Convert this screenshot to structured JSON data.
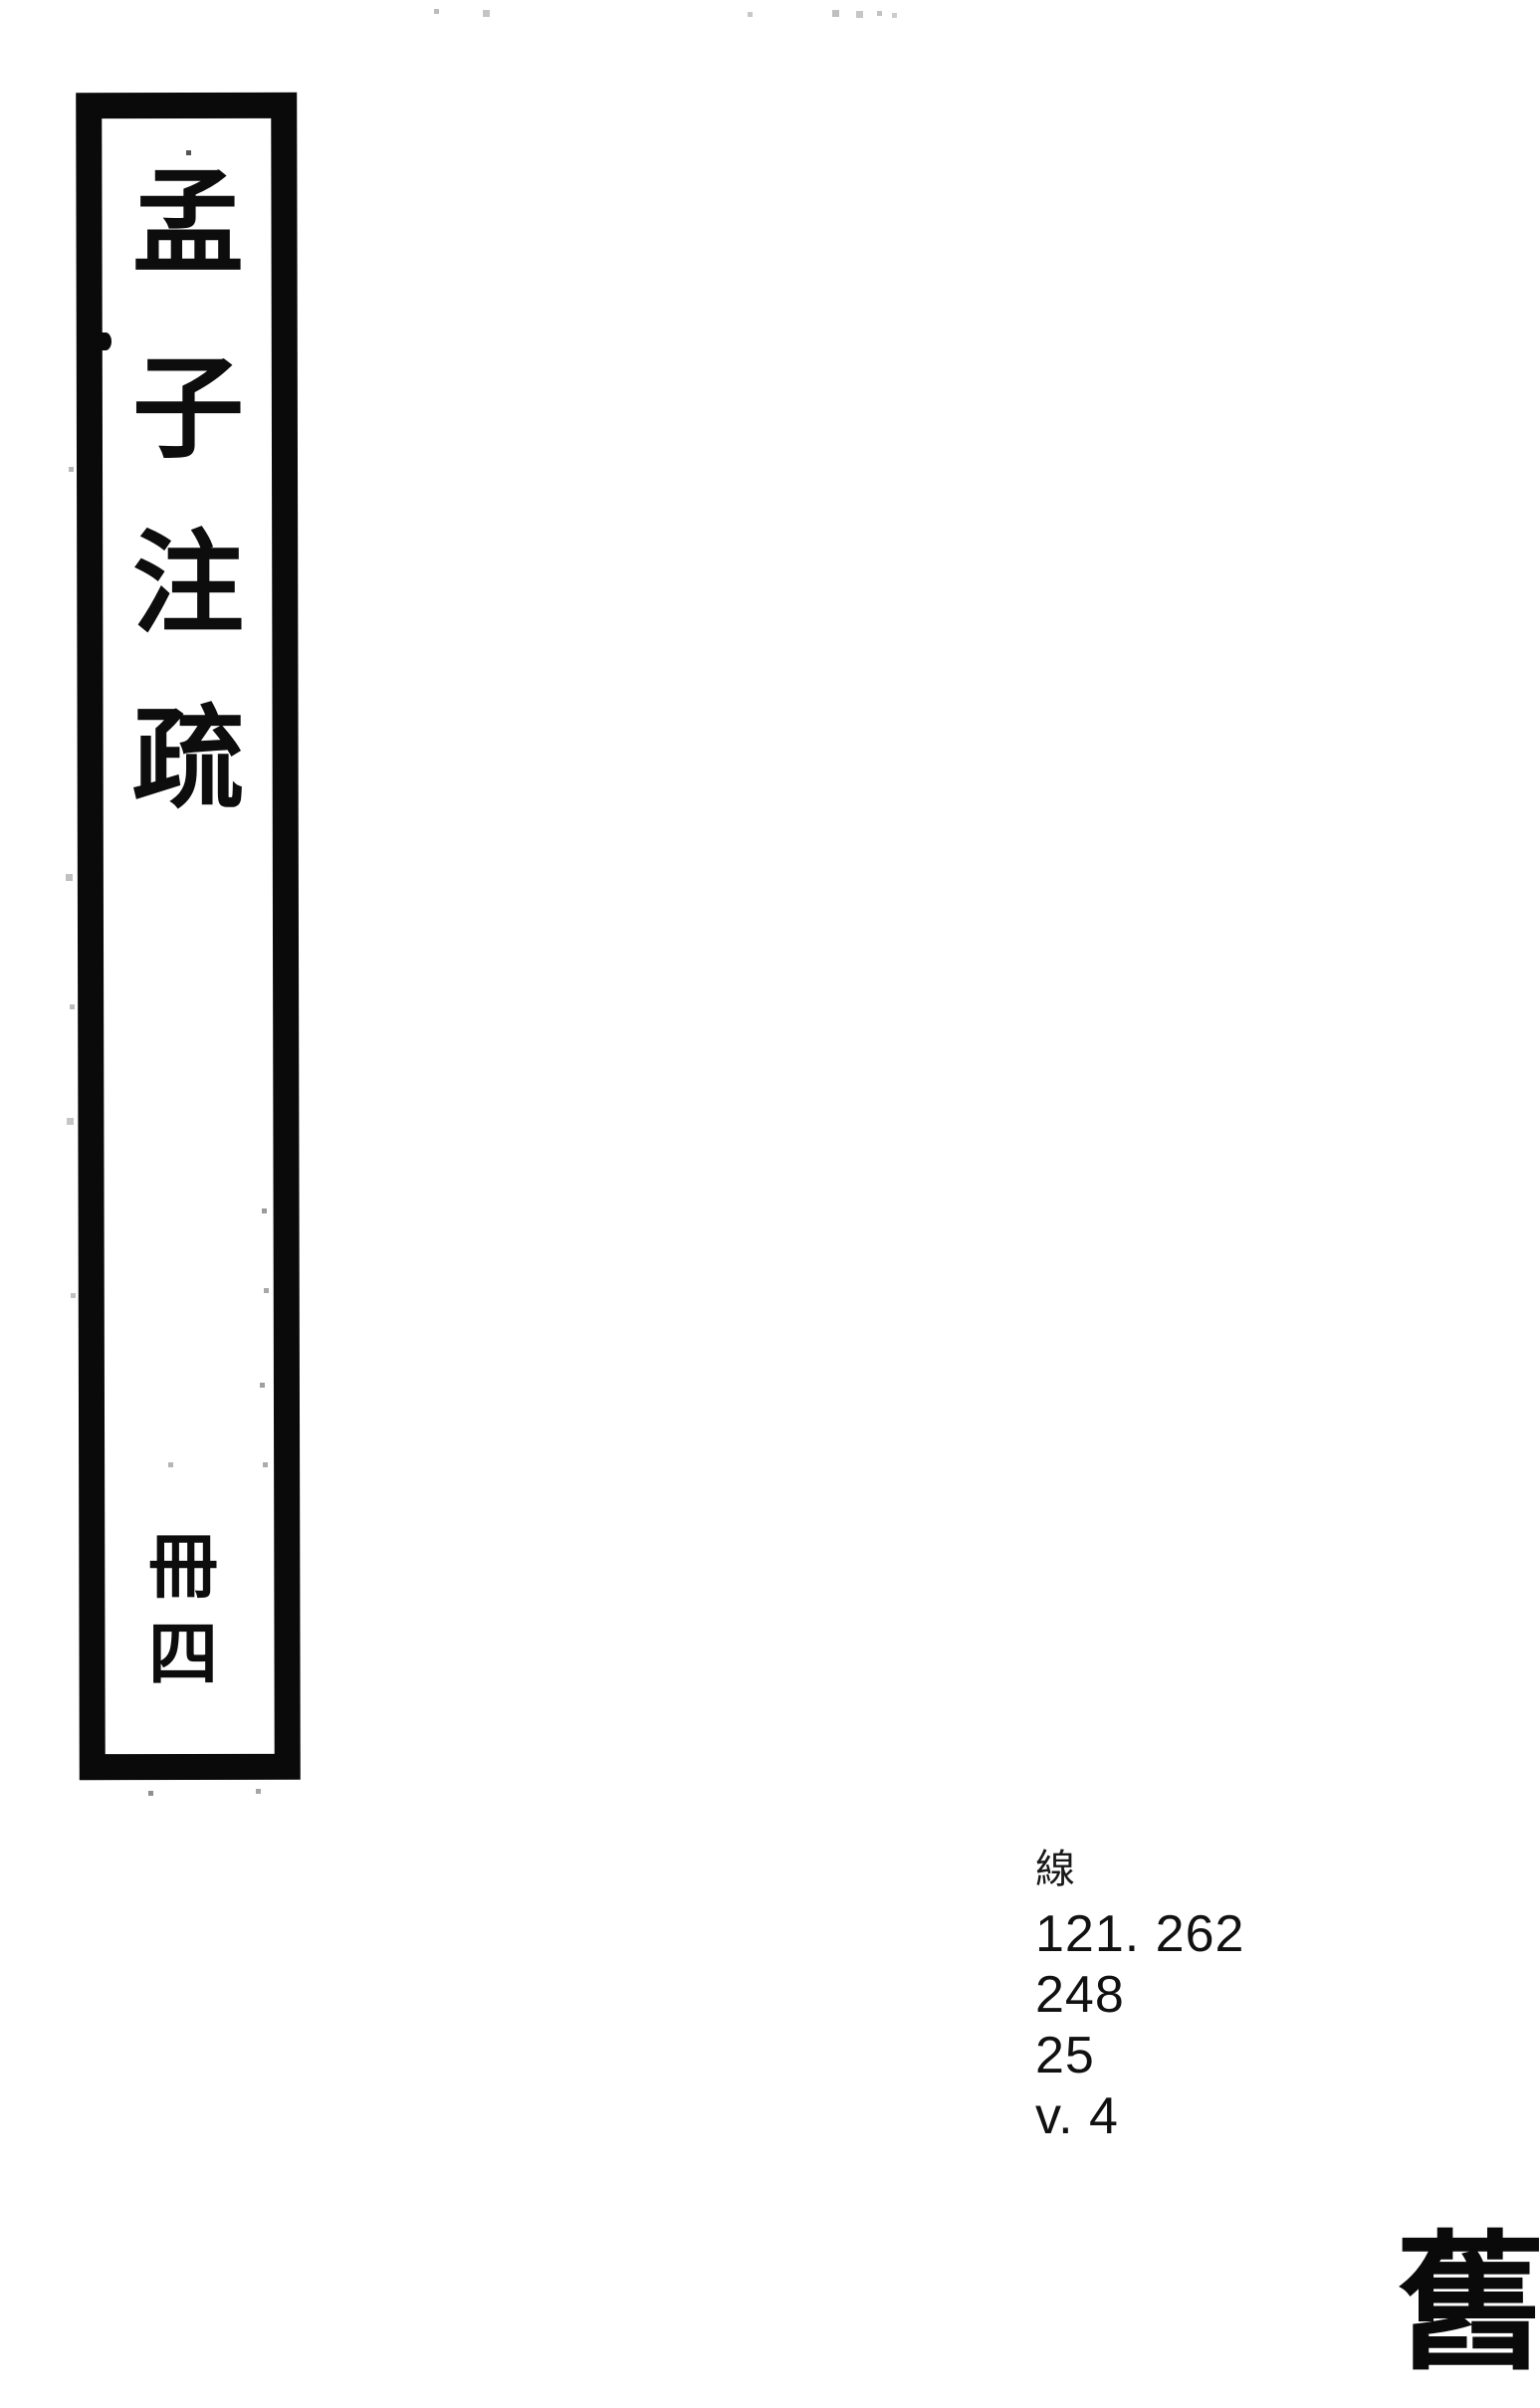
{
  "document": {
    "kind": "scanned book spine label",
    "background_color": "#ffffff",
    "ink_color": "#0a0a0a"
  },
  "spine_label": {
    "title": "孟子注疏",
    "title_chars": [
      "孟",
      "子",
      "注",
      "疏"
    ],
    "volume": "冊四",
    "volume_chars": [
      "冊",
      "四"
    ],
    "border_color": "#0a0a0a"
  },
  "call_number": {
    "script_char": "線",
    "lines": [
      "121. 262",
      "248",
      "25",
      "v. 4"
    ]
  },
  "stamp": {
    "char": "舊"
  }
}
